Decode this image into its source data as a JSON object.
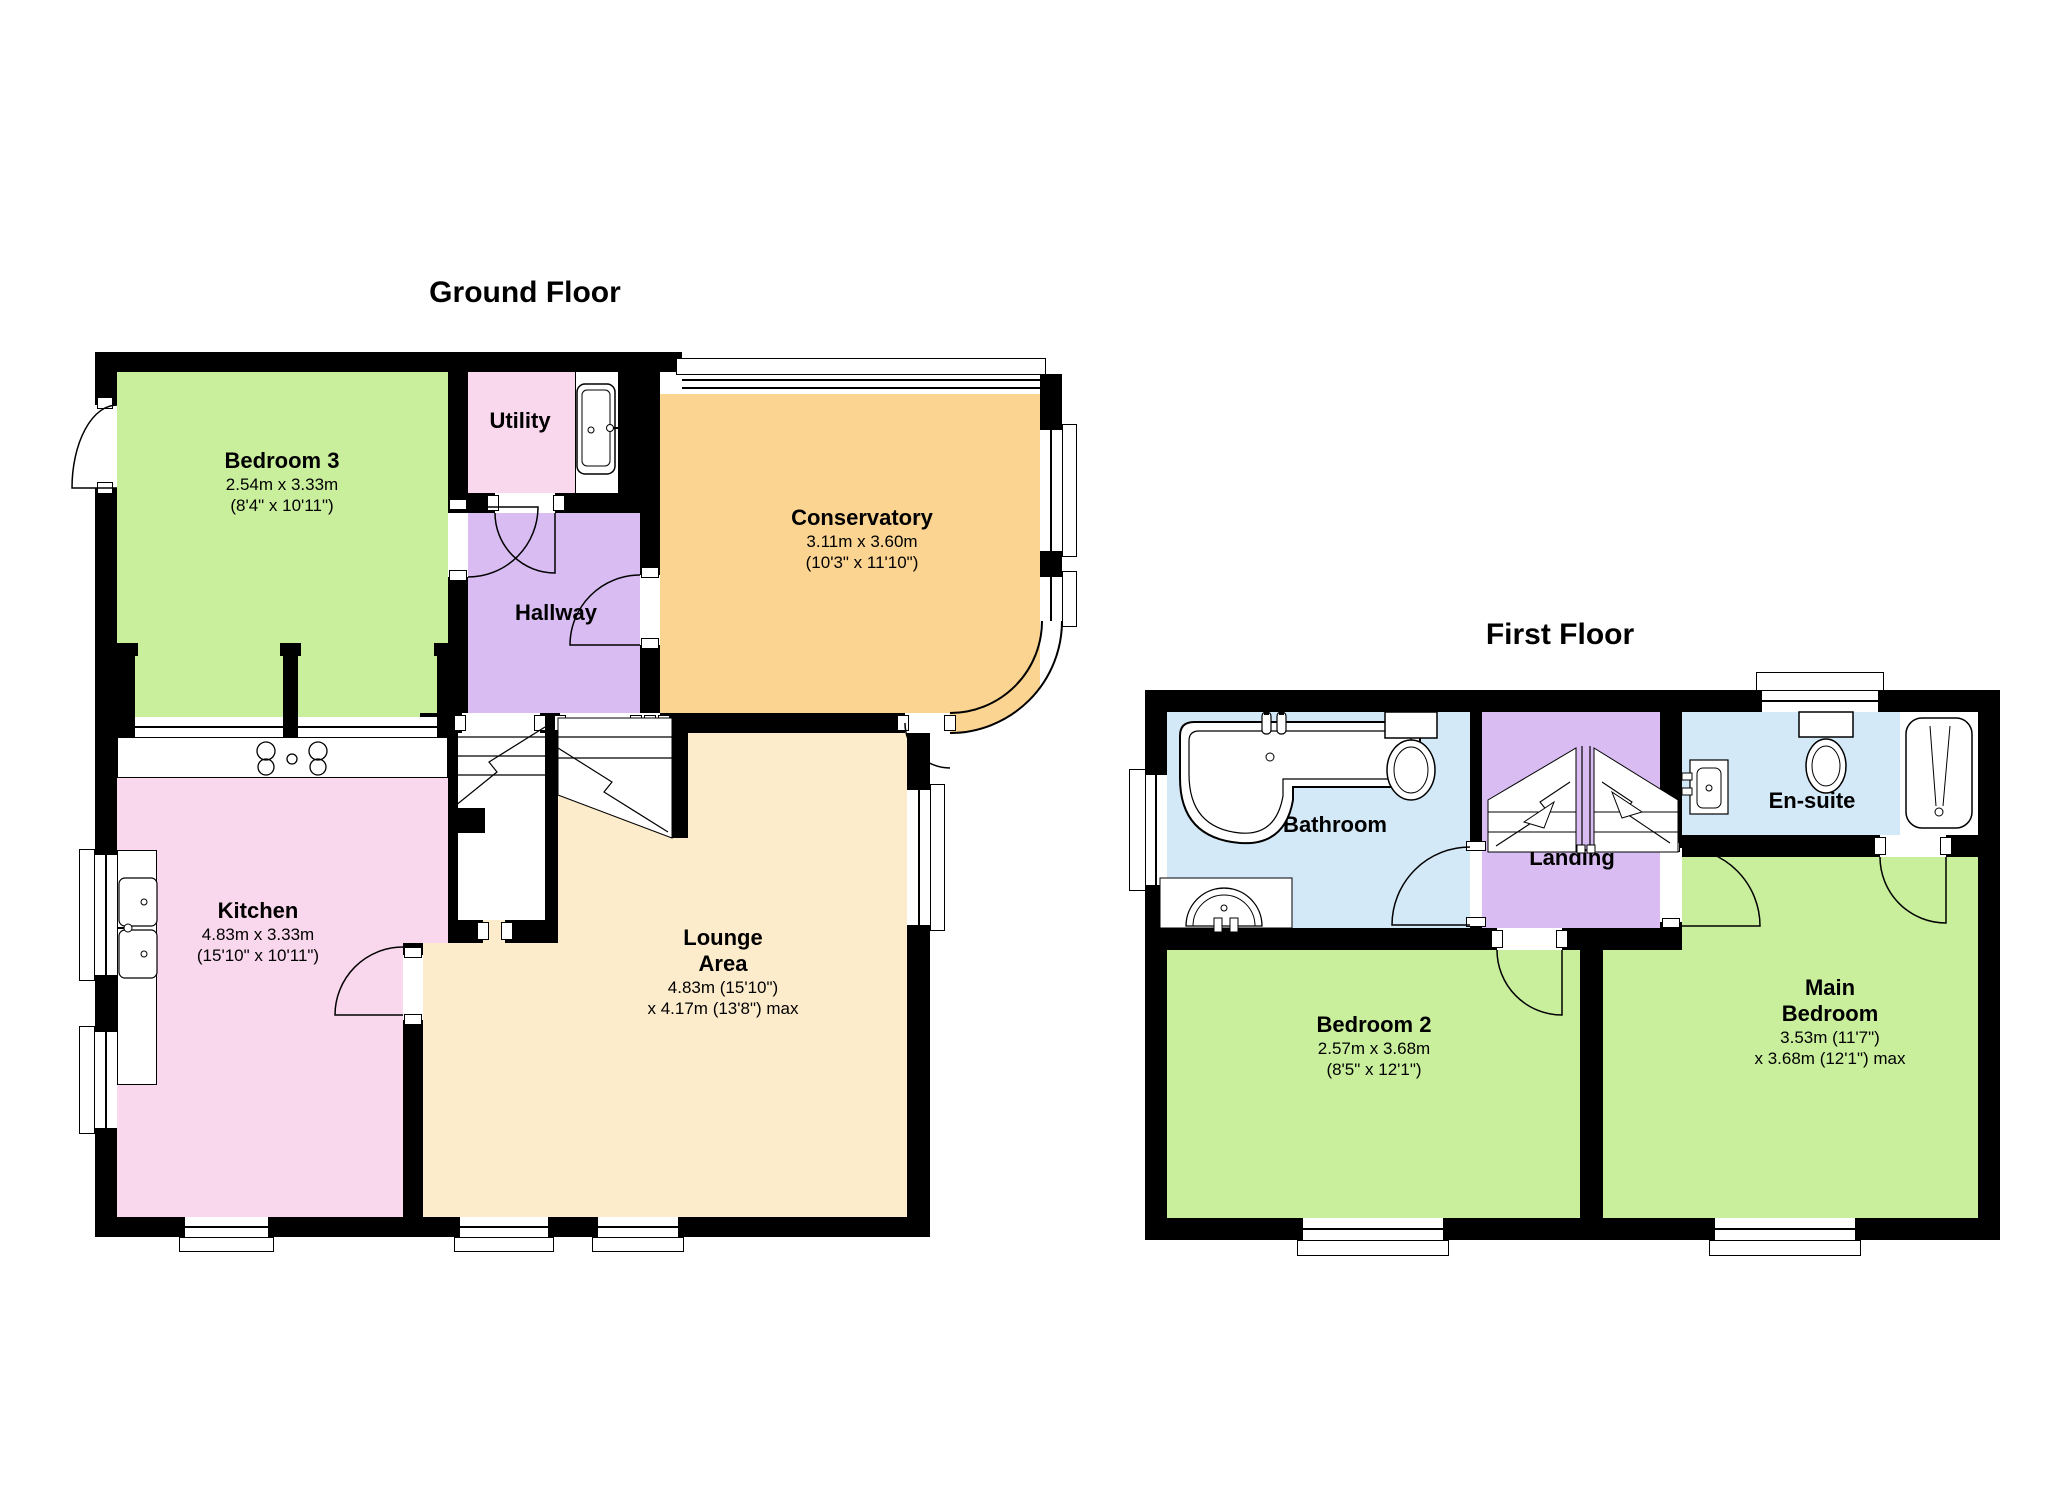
{
  "colors": {
    "wall": "#000000",
    "bedroom": "#c9ef9d",
    "kitchen_pink": "#f9d7ec",
    "hallway_purple": "#d9bdf2",
    "conservatory_orange": "#fbd491",
    "lounge_cream": "#fdeccb",
    "bathroom_blue": "#d4e9f8"
  },
  "ground_floor": {
    "title": "Ground Floor",
    "bedroom3": {
      "name": "Bedroom 3",
      "metric": "2.54m x 3.33m",
      "imperial": "(8'4\" x 10'11\")"
    },
    "utility": {
      "name": "Utility"
    },
    "conservatory": {
      "name": "Conservatory",
      "metric": "3.11m x 3.60m",
      "imperial": "(10'3\" x 11'10\")"
    },
    "hallway": {
      "name": "Hallway"
    },
    "kitchen": {
      "name": "Kitchen",
      "metric": "4.83m x 3.33m",
      "imperial": "(15'10\" x 10'11\")"
    },
    "lounge": {
      "name_line1": "Lounge",
      "name_line2": "Area",
      "metric": "4.83m (15'10\")",
      "imperial_max": "x 4.17m (13'8\") max"
    }
  },
  "first_floor": {
    "title": "First Floor",
    "bathroom": {
      "name": "Bathroom"
    },
    "landing": {
      "name": "Landing"
    },
    "ensuite": {
      "name": "En-suite"
    },
    "bedroom2": {
      "name": "Bedroom 2",
      "metric": "2.57m x 3.68m",
      "imperial": "(8'5\" x 12'1\")"
    },
    "main_bedroom": {
      "name_line1": "Main",
      "name_line2": "Bedroom",
      "metric": "3.53m (11'7\")",
      "imperial_max": "x 3.68m (12'1\") max"
    }
  }
}
